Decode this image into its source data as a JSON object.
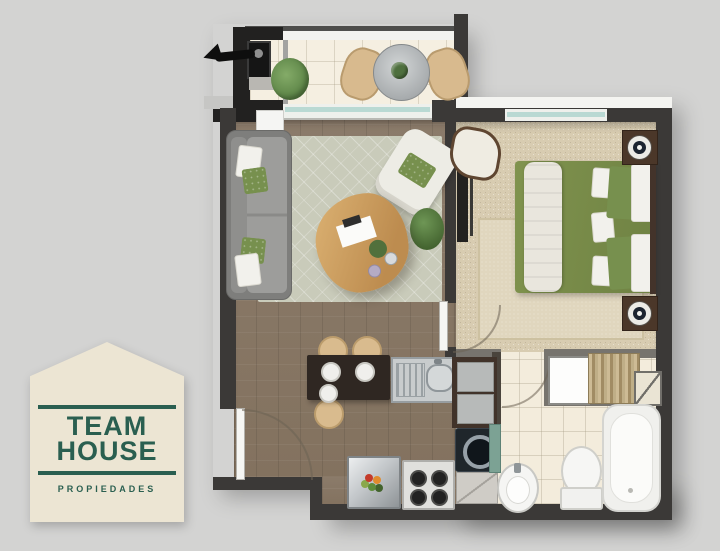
{
  "logo": {
    "title_line1": "TEAM",
    "title_line2": "HOUSE",
    "subtitle": "PROPIEDADES"
  },
  "colors": {
    "bg": "#d3d3d2",
    "wallDark": "#3b3937",
    "wallBlack": "#222120",
    "wood": "#8b7b6a",
    "balconyTile": "#f5efe1",
    "bathTile": "#f3ecdc",
    "carpet": "#d8ccb1",
    "rugLiving": "#c9cbba",
    "rugBedroom": "#e0d6be",
    "sofaGray": "#9d9d9b",
    "bedGreen": "#80934e",
    "pillowGreen": "#77904e",
    "tableWood": "#d2a766",
    "counterDark": "#41332a",
    "steel": "#c8cccd",
    "glassTeal": "#b9d9d3",
    "stoolTan": "#d9bb8e",
    "logoCream": "#ece5d3",
    "logoGreen": "#2a5f50"
  }
}
